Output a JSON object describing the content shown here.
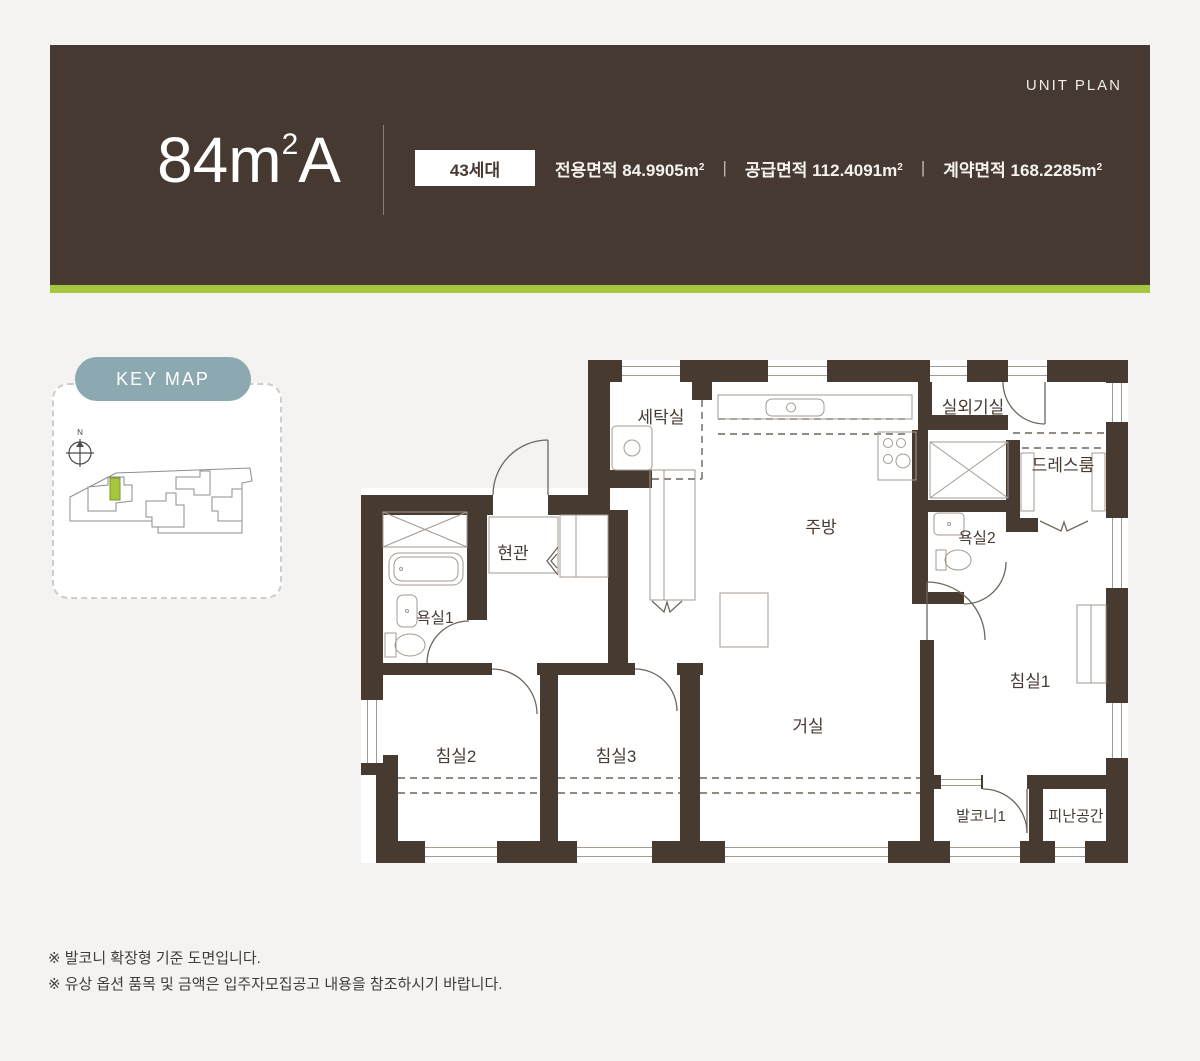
{
  "header": {
    "unit_plan_label": "UNIT PLAN",
    "title": "84m",
    "title_sup": "2",
    "title_suffix": "A",
    "badge": "43세대",
    "separator": "|",
    "areas": [
      {
        "label": "전용면적",
        "value": "84.9905m",
        "sup": "2"
      },
      {
        "label": "공급면적",
        "value": "112.4091m",
        "sup": "2"
      },
      {
        "label": "계약면적",
        "value": "168.2285m",
        "sup": "2"
      }
    ]
  },
  "colors": {
    "header_bg": "#453931",
    "accent_green": "#a5c63d",
    "keymap_pill": "#8ca9b1",
    "wall_brown": "#473a31",
    "page_bg": "#f4f3f1"
  },
  "keymap": {
    "button_label": "KEY MAP",
    "compass_label": "N"
  },
  "floorplan": {
    "rooms": [
      {
        "id": "laundry",
        "label": "세탁실"
      },
      {
        "id": "kitchen",
        "label": "주방"
      },
      {
        "id": "outdoor-unit",
        "label": "실외기실"
      },
      {
        "id": "dressroom",
        "label": "드레스룸"
      },
      {
        "id": "bath2",
        "label": "욕실2"
      },
      {
        "id": "bedroom1",
        "label": "침실1"
      },
      {
        "id": "living",
        "label": "거실"
      },
      {
        "id": "entrance",
        "label": "현관"
      },
      {
        "id": "bath1",
        "label": "욕실1"
      },
      {
        "id": "bedroom2",
        "label": "침실2"
      },
      {
        "id": "bedroom3",
        "label": "침실3"
      },
      {
        "id": "balcony1",
        "label": "발코니1"
      },
      {
        "id": "refuge",
        "label": "피난공간"
      }
    ]
  },
  "footnotes": [
    "※ 발코니 확장형 기준 도면입니다.",
    "※ 유상 옵션 품목 및 금액은 입주자모집공고 내용을 참조하시기 바랍니다."
  ]
}
